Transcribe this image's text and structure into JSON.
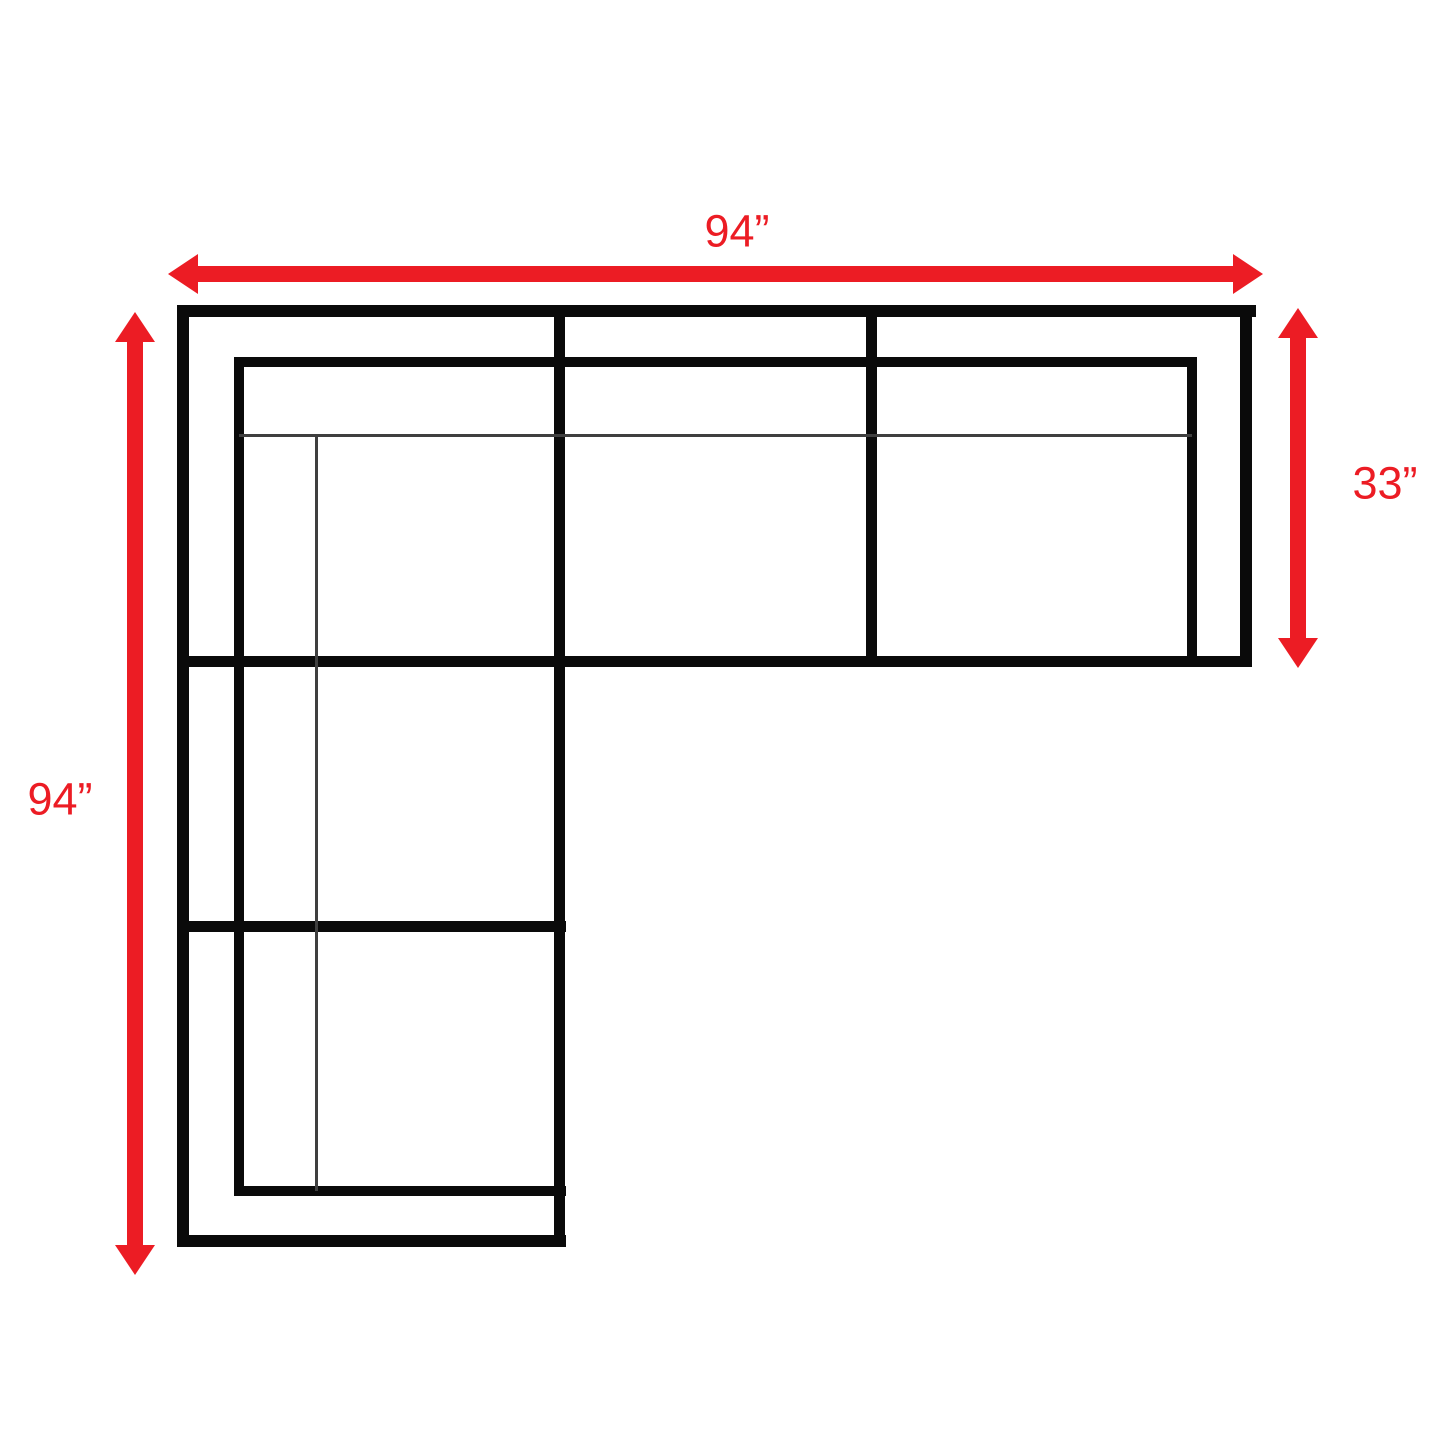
{
  "canvas": {
    "width": 1445,
    "height": 1445,
    "background": "#ffffff"
  },
  "colors": {
    "sofa_outline": "#0a0a0a",
    "cushion_line": "#3f3f3f",
    "dimension_red": "#ec1c24"
  },
  "dimensions": {
    "top": {
      "label": "94”",
      "value_inches": 94
    },
    "left": {
      "label": "94”",
      "value_inches": 94
    },
    "right": {
      "label": "33”",
      "value_inches": 33
    }
  },
  "sofa": {
    "shape": "l-shaped-sectional-top-view",
    "lines": [
      {
        "id": "outer-top-edge",
        "x": 177,
        "y": 305,
        "w": 1079,
        "h": 12,
        "stroke": "thick"
      },
      {
        "id": "outer-left-edge",
        "x": 177,
        "y": 305,
        "w": 12,
        "h": 942,
        "stroke": "thick"
      },
      {
        "id": "outer-right-edge",
        "x": 1240,
        "y": 305,
        "w": 12,
        "h": 362,
        "stroke": "thick"
      },
      {
        "id": "top-arm-front-edge",
        "x": 177,
        "y": 656,
        "w": 1075,
        "h": 11,
        "stroke": "thick"
      },
      {
        "id": "chaise-right-edge",
        "x": 554,
        "y": 305,
        "w": 11,
        "h": 942,
        "stroke": "thick"
      },
      {
        "id": "outer-bottom-edge",
        "x": 177,
        "y": 1235,
        "w": 389,
        "h": 12,
        "stroke": "thick"
      },
      {
        "id": "right-seat-divider",
        "x": 866,
        "y": 305,
        "w": 11,
        "h": 362,
        "stroke": "thick"
      },
      {
        "id": "left-seat-divider",
        "x": 177,
        "y": 921,
        "w": 389,
        "h": 11,
        "stroke": "thick"
      },
      {
        "id": "backrest-inner-top-edge",
        "x": 234,
        "y": 357,
        "w": 963,
        "h": 10,
        "stroke": "thick"
      },
      {
        "id": "backrest-inner-left-edge",
        "x": 234,
        "y": 357,
        "w": 10,
        "h": 839,
        "stroke": "thick"
      },
      {
        "id": "right-arm-inner-edge",
        "x": 1187,
        "y": 357,
        "w": 10,
        "h": 310,
        "stroke": "thick"
      },
      {
        "id": "bottom-arm-inner-edge",
        "x": 234,
        "y": 1186,
        "w": 332,
        "h": 10,
        "stroke": "thick"
      },
      {
        "id": "back-cushion-line-horizontal",
        "x": 239,
        "y": 434,
        "w": 953,
        "h": 3,
        "stroke": "thin"
      },
      {
        "id": "back-cushion-line-vertical",
        "x": 315,
        "y": 434,
        "w": 3,
        "h": 757,
        "stroke": "thin"
      }
    ]
  },
  "arrows": [
    {
      "id": "dimension-arrow-top-width",
      "orientation": "horizontal",
      "from": 168,
      "to": 1263,
      "center": 274
    },
    {
      "id": "dimension-arrow-left-depth",
      "orientation": "vertical",
      "from": 312,
      "to": 1275,
      "center": 135
    },
    {
      "id": "dimension-arrow-right-depth",
      "orientation": "vertical",
      "from": 308,
      "to": 668,
      "center": 1298
    }
  ]
}
